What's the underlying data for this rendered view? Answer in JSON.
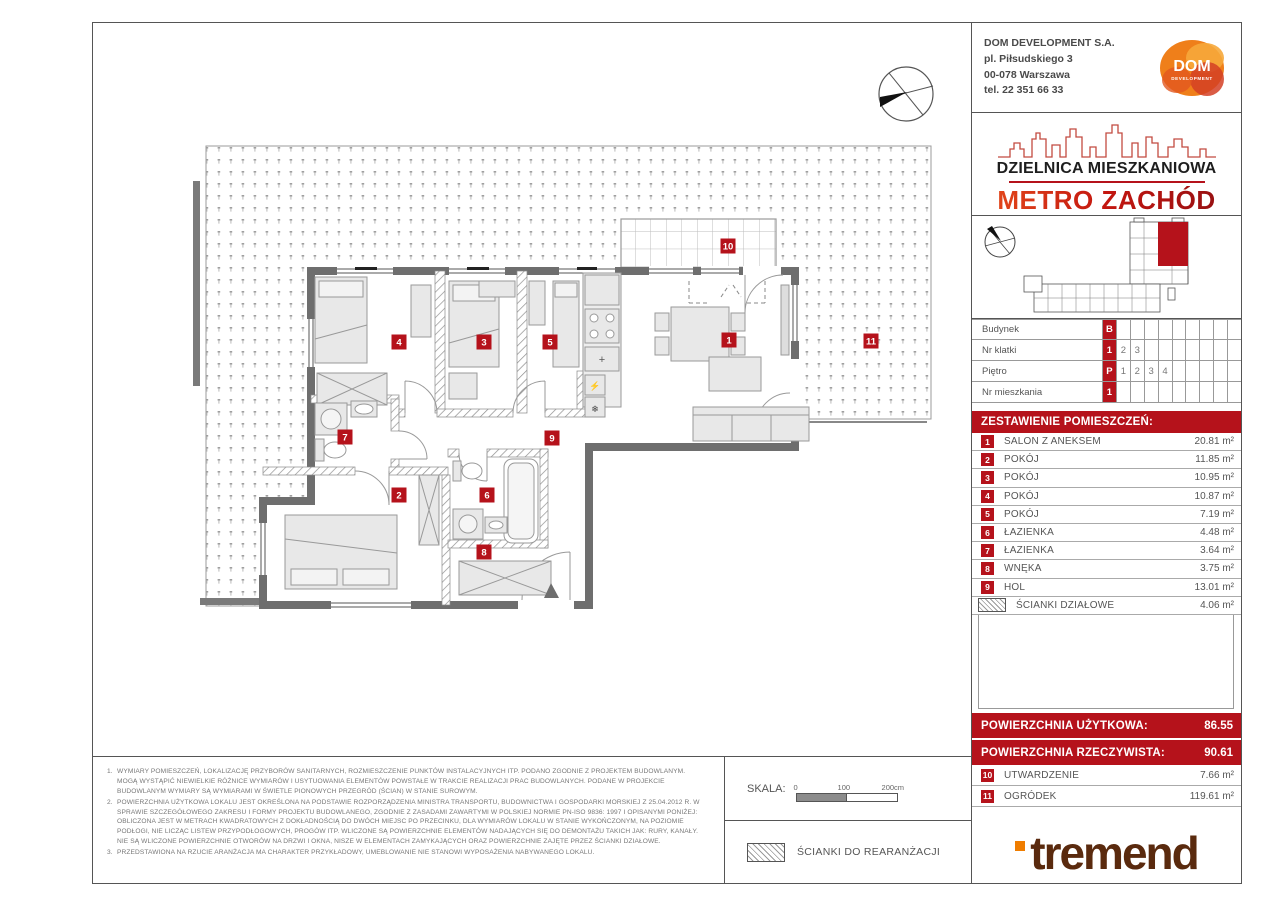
{
  "accent": "#b5121b",
  "company": {
    "name": "DOM DEVELOPMENT S.A.",
    "address1": "pl. Piłsudskiego 3",
    "address2": "00-078 Warszawa",
    "phone": "tel. 22 351 66 33",
    "logo_main": "DOM",
    "logo_sub": "DEVELOPMENT"
  },
  "brand": {
    "district": "DZIELNICA MIESZKANIOWA",
    "project": "METRO ZACHÓD"
  },
  "info_table": {
    "rows": [
      {
        "label": "Budynek",
        "cells": [
          "B",
          "",
          "",
          "",
          "",
          "",
          "",
          "",
          "",
          ""
        ]
      },
      {
        "label": "Nr klatki",
        "cells": [
          "1",
          "2",
          "3",
          "",
          "",
          "",
          "",
          "",
          "",
          ""
        ]
      },
      {
        "label": "Piętro",
        "cells": [
          "P",
          "1",
          "2",
          "3",
          "4",
          "",
          "",
          "",
          "",
          ""
        ]
      },
      {
        "label": "Nr mieszkania",
        "cells": [
          "1",
          "",
          "",
          "",
          "",
          "",
          "",
          "",
          "",
          ""
        ]
      }
    ]
  },
  "rooms": {
    "header": "ZESTAWIENIE POMIESZCZEŃ:",
    "items": [
      {
        "num": "1",
        "name": "SALON Z ANEKSEM",
        "area": "20.81 m²"
      },
      {
        "num": "2",
        "name": "POKÓJ",
        "area": "11.85 m²"
      },
      {
        "num": "3",
        "name": "POKÓJ",
        "area": "10.95 m²"
      },
      {
        "num": "4",
        "name": "POKÓJ",
        "area": "10.87 m²"
      },
      {
        "num": "5",
        "name": "POKÓJ",
        "area": "7.19 m²"
      },
      {
        "num": "6",
        "name": "ŁAZIENKA",
        "area": "4.48 m²"
      },
      {
        "num": "7",
        "name": "ŁAZIENKA",
        "area": "3.64 m²"
      },
      {
        "num": "8",
        "name": "WNĘKA",
        "area": "3.75 m²"
      },
      {
        "num": "9",
        "name": "HOL",
        "area": "13.01 m²"
      },
      {
        "num": "",
        "name": "ŚCIANKI DZIAŁOWE",
        "area": "4.06 m²",
        "swatch": true
      }
    ]
  },
  "totals": {
    "usable_label": "POWIERZCHNIA UŻYTKOWA:",
    "usable_value": "86.55",
    "actual_label": "POWIERZCHNIA RZECZYWISTA:",
    "actual_value": "90.61"
  },
  "outdoor": {
    "items": [
      {
        "num": "10",
        "name": "UTWARDZENIE",
        "area": "7.66 m²"
      },
      {
        "num": "11",
        "name": "OGRÓDEK",
        "area": "119.61 m²"
      }
    ]
  },
  "tremend_logo": "tremend",
  "footer": {
    "scale_label": "SKALA:",
    "scale_ticks": [
      "0",
      "100",
      "200cm"
    ],
    "legend": "ŚCIANKI DO REARANŻACJI",
    "notes": [
      "WYMIARY POMIESZCZEŃ, LOKALIZACJĘ PRZYBORÓW SANITARNYCH, ROZMIESZCZENIE PUNKTÓW INSTALACYJNYCH ITP. PODANO ZGODNIE Z PROJEKTEM BUDOWLANYM. MOGĄ WYSTĄPIĆ NIEWIELKIE RÓŻNICE WYMIARÓW I USYTUOWANIA ELEMENTÓW POWSTAŁE W TRAKCIE REALIZACJI PRAC BUDOWLANYCH. PODANE W PROJEKCIE BUDOWLANYM WYMIARY SĄ WYMIARAMI W ŚWIETLE PIONOWYCH PRZEGRÓD (ŚCIAN) W STANIE SUROWYM.",
      "POWIERZCHNIA UŻYTKOWA LOKALU JEST OKREŚLONA NA PODSTAWIE ROZPORZĄDZENIA MINISTRA TRANSPORTU, BUDOWNICTWA I GOSPODARKI MORSKIEJ Z 25.04.2012 R. W SPRAWIE SZCZEGÓŁOWEGO ZAKRESU I FORMY PROJEKTU BUDOWLANEGO, ZGODNIE Z ZASADAMI ZAWARTYMI W POLSKIEJ NORMIE PN-ISO 9836: 1997 I OPISANYMI PONIŻEJ: OBLICZONA JEST W METRACH KWADRATOWYCH Z DOKŁADNOŚCIĄ DO DWÓCH MIEJSC PO PRZECINKU, DLA WYMIARÓW LOKALU W STANIE WYKOŃCZONYM, NA POZIOMIE PODŁOGI, NIE LICZĄC LISTEW PRZYPODŁOGOWYCH, PROGÓW ITP. WLICZONE SĄ POWIERZCHNIE ELEMENTÓW NADAJĄCYCH SIĘ DO DEMONTAŻU TAKICH JAK: RURY, KANAŁY. NIE SĄ WLICZONE POWIERZCHNIE OTWORÓW NA DRZWI I OKNA, NISZE W ELEMENTACH ZAMYKAJĄCYCH ORAZ POWIERZCHNIE ZAJĘTE PRZEZ ŚCIANKI DZIAŁOWE.",
      "PRZEDSTAWIONA NA RZUCIE ARANŻACJA MA CHARAKTER PRZYKŁADOWY, UMEBLOWANIE NIE STANOWI WYPOSAŻENIA NABYWANEGO LOKALU."
    ]
  },
  "plan": {
    "markers": [
      {
        "n": "1",
        "x": 636,
        "y": 317
      },
      {
        "n": "2",
        "x": 306,
        "y": 472
      },
      {
        "n": "3",
        "x": 391,
        "y": 319
      },
      {
        "n": "4",
        "x": 306,
        "y": 319
      },
      {
        "n": "5",
        "x": 457,
        "y": 319
      },
      {
        "n": "6",
        "x": 394,
        "y": 472
      },
      {
        "n": "7",
        "x": 252,
        "y": 414
      },
      {
        "n": "8",
        "x": 391,
        "y": 529
      },
      {
        "n": "9",
        "x": 459,
        "y": 415
      },
      {
        "n": "10",
        "x": 635,
        "y": 223
      },
      {
        "n": "11",
        "x": 778,
        "y": 318
      }
    ]
  }
}
